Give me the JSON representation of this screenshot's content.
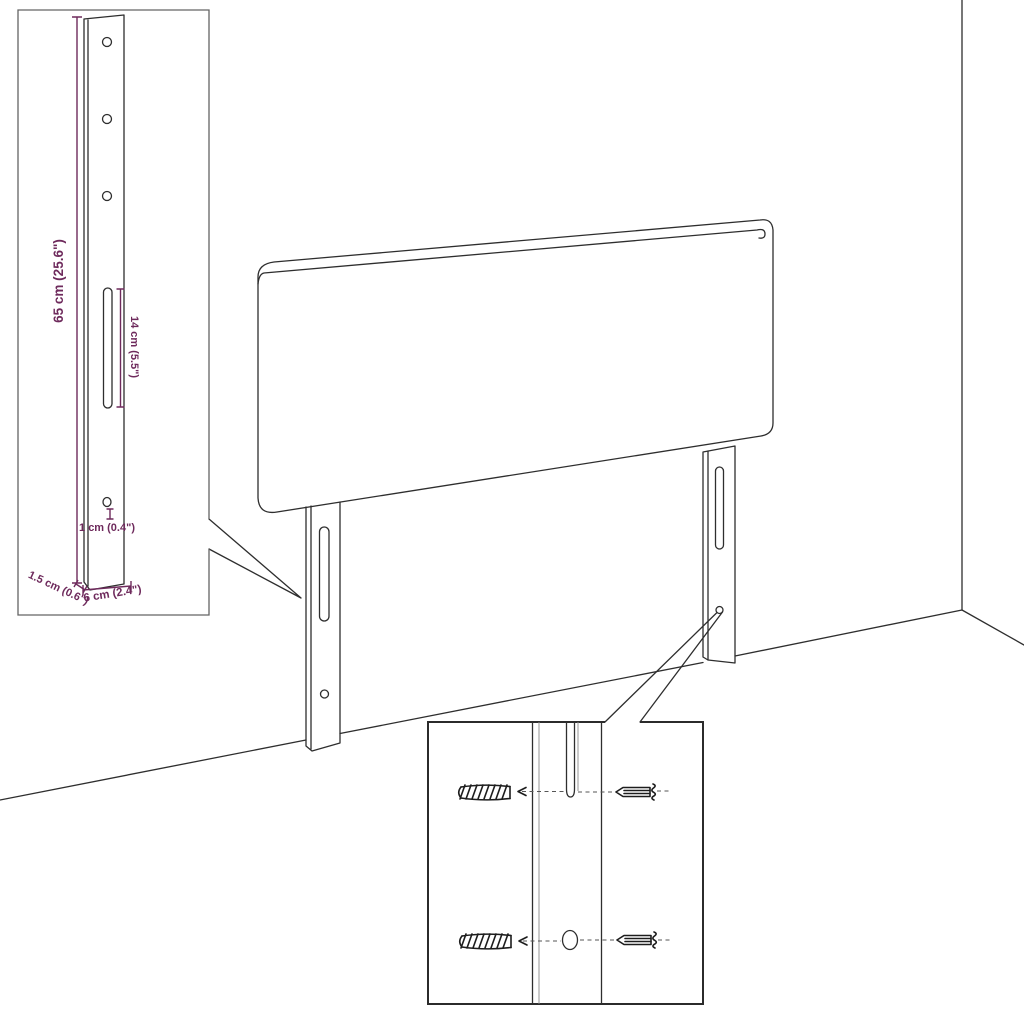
{
  "figure": {
    "colors": {
      "line": "#2e2e2e",
      "dimension": "#6e2a5c",
      "inset_border": "#646464",
      "detail_border": "#2b2b2b",
      "background": "#ffffff"
    },
    "icons": [
      "screw-icon",
      "wall-plug-icon"
    ],
    "inset": {
      "dimensions": {
        "height": "65 cm (25.6\")",
        "slot_length": "14 cm (5.5\")",
        "hole": "1 cm (0.4\")",
        "thickness": "1.5 cm (0.6\")",
        "width": "6 cm (2.4\")"
      }
    }
  }
}
